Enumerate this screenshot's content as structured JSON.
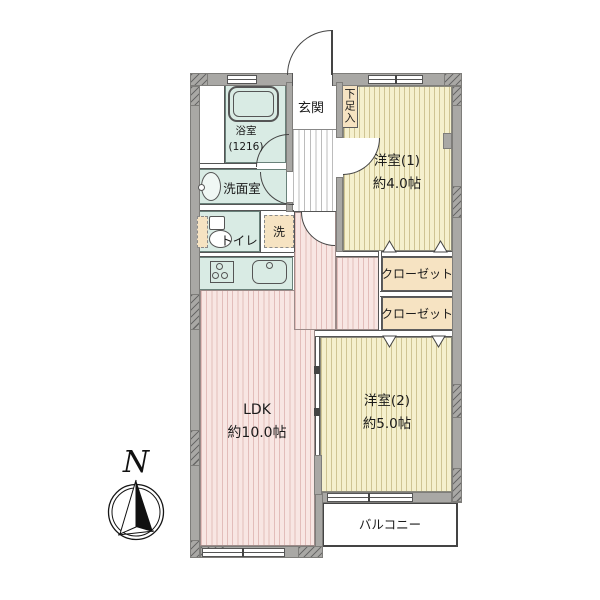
{
  "floorplan": {
    "compass_label": "N",
    "rooms": {
      "genkan": "玄関",
      "shoe_storage": "下足入",
      "bathroom_line1": "浴室",
      "bathroom_line2": "(1216)",
      "washroom": "洗面室",
      "toilet": "トイレ",
      "laundry": "洗",
      "room1_line1": "洋室(1)",
      "room1_line2": "約4.0帖",
      "closet1": "クローゼット",
      "closet2": "クローゼット",
      "room2_line1": "洋室(2)",
      "room2_line2": "約5.0帖",
      "ldk_line1": "LDK",
      "ldk_line2": "約10.0帖",
      "balcony": "バルコニー"
    },
    "colors": {
      "wall": "#a9a8a5",
      "wet_area": "#d9ebe4",
      "room_floor": "#f5f0cd",
      "room_floor_stripe": "#cfc493",
      "ldk_floor": "#f8e6e3",
      "ldk_floor_stripe": "#e2bdba",
      "storage": "#f6e3c2",
      "corridor_stripe": "#bcbcbc",
      "line": "#4a4a4a"
    }
  }
}
